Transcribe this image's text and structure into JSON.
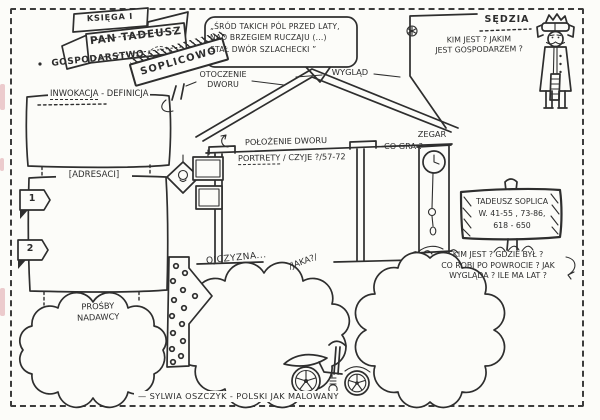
{
  "header": {
    "book": "KSIĘGA I",
    "title": "PAN TADEUSZ",
    "subtitle": "GOSPODARSTWO",
    "number": "1",
    "place_sign": "SOPLICOWO"
  },
  "quote": {
    "lines": [
      "„ŚRÓD TAKICH PÓL PRZED LATY,",
      "NAD BRZEGIEM RUCZAJU (...)",
      "STAŁ DWÓR SZLACHECKI ”"
    ]
  },
  "manor": {
    "otoczenie_line1": "OTOCZENIE",
    "otoczenie_line2": "DWORU",
    "wyglad": "WYGLĄD",
    "polozenie": "POŁOŻENIE DWORU",
    "portrety": "PORTRETY",
    "portrety_detail": "/ CZYJE ?/57-72",
    "zegar": "ZEGAR",
    "zegar_question": "CO GRA ?"
  },
  "invocation": {
    "label": "INWOKACJA",
    "definition": "- DEFINICJA"
  },
  "addressees": {
    "label": "[ADRESACI]",
    "tab1": "1",
    "tab2": "2",
    "requests_line1": "PROŚBY",
    "requests_line2": "NADAWCY"
  },
  "homeland": {
    "label": "OJCZYZNA...",
    "question": "/JAKA?/"
  },
  "judge": {
    "title": "SĘDZIA",
    "question_line1": "KIM JEST ? JAKIM",
    "question_line2": "JEST GOSPODARZEM ?"
  },
  "tadeusz": {
    "sign_line1": "TADEUSZ SOPLICA",
    "sign_line2": "W. 41-55 , 73-86,",
    "sign_line3": "618 - 650",
    "question_line1": "KIM JEST ? GDZIE BYŁ ?",
    "question_line2": "CO ROBI PO POWROCIE ? JAK",
    "question_line3": "WYGLĄDA ? ILE MA LAT ?"
  },
  "footer": {
    "credit": "— SYLWIA OSZCZYK - POLSKI JAK MALOWANY"
  },
  "colors": {
    "ink": "#2e2e2e",
    "paper": "#fcfcf9",
    "smudge": "#dfa3aa"
  }
}
